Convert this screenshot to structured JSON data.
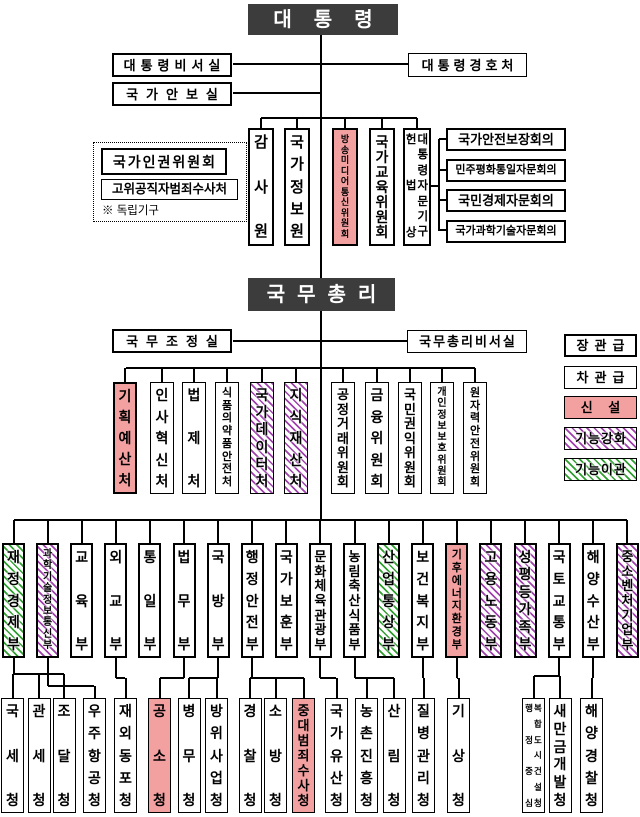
{
  "colors": {
    "header_bg": "#3C3C3C",
    "new_fill": "#F3A0A1",
    "enhanced_stripe": "#A03FAE",
    "transferred_stripe": "#2FA02F",
    "line": "#000000"
  },
  "president": {
    "title": "대통령"
  },
  "president_offices": {
    "secretariat": "대통령비서실",
    "national_security_office": "국가안보실",
    "security_service": "대통령경호처"
  },
  "independent_bodies": {
    "note": "※ 독립기구",
    "items": [
      {
        "label": "국가인권위원회",
        "rank": "minister"
      },
      {
        "label": "고위공직자범죄수사처",
        "rank": "vice_minister"
      }
    ]
  },
  "president_direct": [
    {
      "label": "감사원"
    },
    {
      "label": "국가정보원"
    },
    {
      "label": "방송미디어통신위원회",
      "status": "new"
    },
    {
      "label": "국가교육위원회"
    },
    {
      "label": "헌법상 대통령자문기구",
      "cols": [
        "헌법상",
        "대통령자문기구"
      ]
    }
  ],
  "advisory_councils": [
    "국가안전보장회의",
    "민주평화통일자문회의",
    "국민경제자문회의",
    "국가과학기술자문회의"
  ],
  "prime_minister": {
    "title": "국무총리"
  },
  "pm_offices": {
    "coordination_office": "국무조정실",
    "secretariat": "국무총리비서실"
  },
  "pm_agencies": [
    {
      "label": "기획예산처",
      "status": "new",
      "rank": "minister"
    },
    {
      "label": "인사혁신처"
    },
    {
      "label": "법제처"
    },
    {
      "label": "식품의약품안전처"
    },
    {
      "label": "국가데이터처",
      "status": "enhanced"
    },
    {
      "label": "지식재산처",
      "status": "enhanced"
    },
    {
      "label": "공정거래위원회"
    },
    {
      "label": "금융위원회"
    },
    {
      "label": "국민권익위원회"
    },
    {
      "label": "개인정보보호위원회"
    },
    {
      "label": "원자력안전위원회"
    }
  ],
  "ministries": [
    {
      "label": "재정경제부",
      "status": "transferred"
    },
    {
      "label": "과학기술정보통신부",
      "status": "enhanced"
    },
    {
      "label": "교육부"
    },
    {
      "label": "외교부"
    },
    {
      "label": "통일부"
    },
    {
      "label": "법무부"
    },
    {
      "label": "국방부"
    },
    {
      "label": "행정안전부"
    },
    {
      "label": "국가보훈부"
    },
    {
      "label": "문화체육관광부"
    },
    {
      "label": "농림축산식품부"
    },
    {
      "label": "산업통상부",
      "status": "transferred"
    },
    {
      "label": "보건복지부"
    },
    {
      "label": "기후에너지환경부",
      "status": "new"
    },
    {
      "label": "고용노동부",
      "status": "enhanced"
    },
    {
      "label": "성평등가족부",
      "status": "enhanced"
    },
    {
      "label": "국토교통부"
    },
    {
      "label": "해양수산부"
    },
    {
      "label": "중소벤처기업부",
      "status": "enhanced"
    }
  ],
  "agencies": [
    {
      "label": "국세청",
      "reports_to": "재정경제부"
    },
    {
      "label": "관세청",
      "reports_to": "재정경제부"
    },
    {
      "label": "조달청",
      "reports_to": "재정경제부"
    },
    {
      "label": "우주항공청",
      "reports_to": "과학기술정보통신부"
    },
    {
      "label": "재외동포청",
      "reports_to": "외교부"
    },
    {
      "label": "공소청",
      "status": "new",
      "reports_to": "법무부"
    },
    {
      "label": "병무청",
      "reports_to": "국방부"
    },
    {
      "label": "방위사업청",
      "reports_to": "국방부"
    },
    {
      "label": "경찰청",
      "reports_to": "행정안전부"
    },
    {
      "label": "소방청",
      "reports_to": "행정안전부"
    },
    {
      "label": "중대범죄수사청",
      "status": "new",
      "reports_to": "행정안전부"
    },
    {
      "label": "국가유산청",
      "reports_to": "문화체육관광부"
    },
    {
      "label": "농촌진흥청",
      "reports_to": "농림축산식품부"
    },
    {
      "label": "산림청",
      "reports_to": "농림축산식품부"
    },
    {
      "label": "질병관리청",
      "reports_to": "보건복지부"
    },
    {
      "label": "기상청",
      "reports_to": "기후에너지환경부"
    },
    {
      "label": "행정중심복합도시건설청",
      "cols": [
        "행정중심",
        "복합도시건설청"
      ],
      "reports_to": "국토교통부"
    },
    {
      "label": "새만금개발청",
      "reports_to": "국토교통부"
    },
    {
      "label": "해양경찰청",
      "reports_to": "해양수산부"
    }
  ],
  "legend": {
    "items": [
      {
        "label": "장관급",
        "style": "minister"
      },
      {
        "label": "차관급",
        "style": "vice_minister"
      },
      {
        "label": "신 설",
        "style": "new"
      },
      {
        "label": "기능강화",
        "style": "enhanced"
      },
      {
        "label": "기능이관",
        "style": "transferred"
      }
    ]
  }
}
